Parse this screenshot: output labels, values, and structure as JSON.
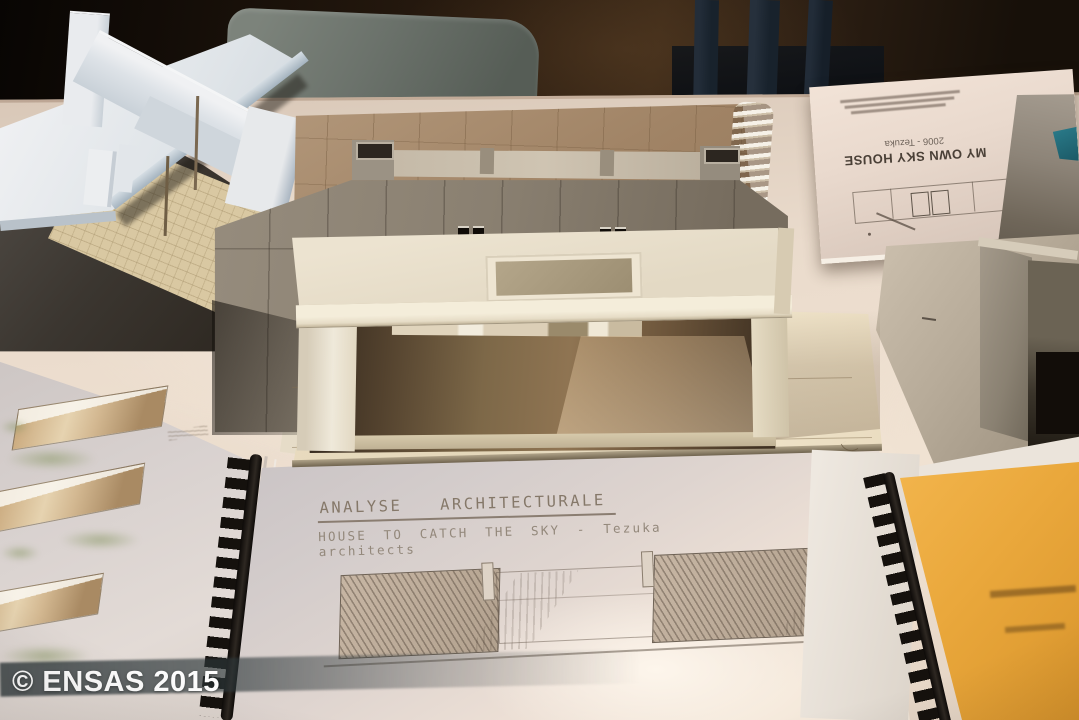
{
  "scene": {
    "watermark": "© ENSAS 2015",
    "analysis_booklet": {
      "title": "ANALYSE ARCHITECTURALE",
      "subtitle": "HOUSE TO CATCH THE SKY - Tezuka architects"
    },
    "flipped_booklet": {
      "title": "MY OWN SKY HOUSE",
      "subtitle": "2006 - Tezuka"
    }
  },
  "colors": {
    "background_wall": "#241a10",
    "table_surface": "#ecdfd3",
    "kraft_sketchbook": "#9d8164",
    "gray_model_wall": "#877d6f",
    "cream_model": "#e8dfcc",
    "yellow_cover": "#eca93f",
    "teal_patch": "#206a78",
    "chair": "#6b726b",
    "comb_binding": "#17130f",
    "watermark_text": "#ffffff"
  }
}
